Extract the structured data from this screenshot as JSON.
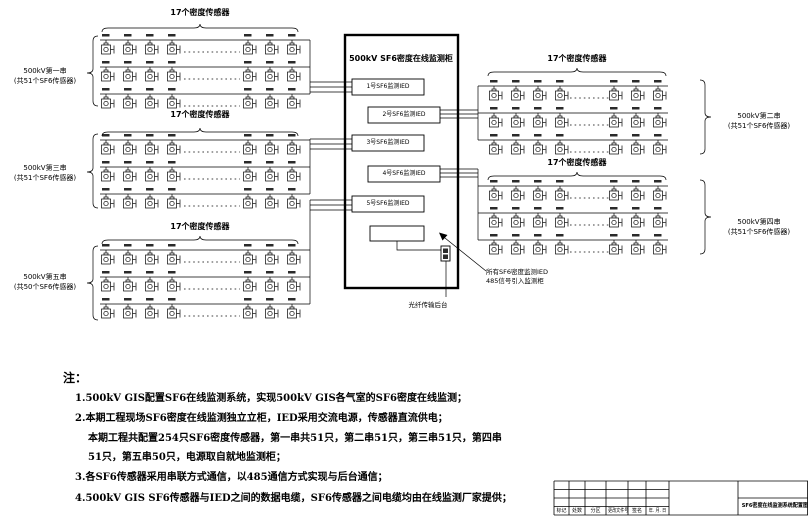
{
  "diagram": {
    "cabinet": {
      "title": "500kV SF6密度在线监测柜",
      "ied_labels": [
        "1号SF6监测IED",
        "2号SF6监测IED",
        "3号SF6监测IED",
        "4号SF6监测IED",
        "5号SF6监测IED"
      ]
    },
    "groups": [
      {
        "top_label": "17个密度传感器",
        "name": "500kV第一串",
        "count": "(共51个SF6传感器)"
      },
      {
        "top_label": "17个密度传感器",
        "name": "500kV第二串",
        "count": "(共51个SF6传感器)"
      },
      {
        "top_label": "17个密度传感器",
        "name": "500kV第三串",
        "count": "(共51个SF6传感器)"
      },
      {
        "top_label": "17个密度传感器",
        "name": "500kV第四串",
        "count": "(共51个SF6传感器)"
      },
      {
        "top_label": "17个密度传感器",
        "name": "500kV第五串",
        "count": "(共50个SF6传感器)"
      }
    ],
    "fiber_note": "光纤传输后台",
    "annotation_line1": "所有SF6密度监测IED",
    "annotation_line2": "485信号引入监测柜"
  },
  "notes": {
    "heading": "注：",
    "items": [
      "1.500kV GIS配置SF6在线监测系统，实现500kV GIS各气室的SF6密度在线监测；",
      "2.本期工程现场SF6密度在线监测独立立柜，IED采用交流电源，传感器直流供电；",
      "本期工程共配置254只SF6密度传感器，第一串共51只，第二串51只，第三串51只，第四串",
      "51只，第五串50只，电源取自就地监测柜；",
      "3.各SF6传感器采用串联方式通信，以485通信方式实现与后台通信；",
      "4.500kV GIS SF6传感器与IED之间的数据电缆，SF6传感器之间电缆均由在线监测厂家提供；"
    ]
  },
  "title_block": {
    "columns": [
      "标记",
      "处数",
      "分区",
      "更改文件号",
      "签名",
      "年. 月. 日"
    ],
    "drawing_title": "SF6密度在线监测系统配置图"
  }
}
